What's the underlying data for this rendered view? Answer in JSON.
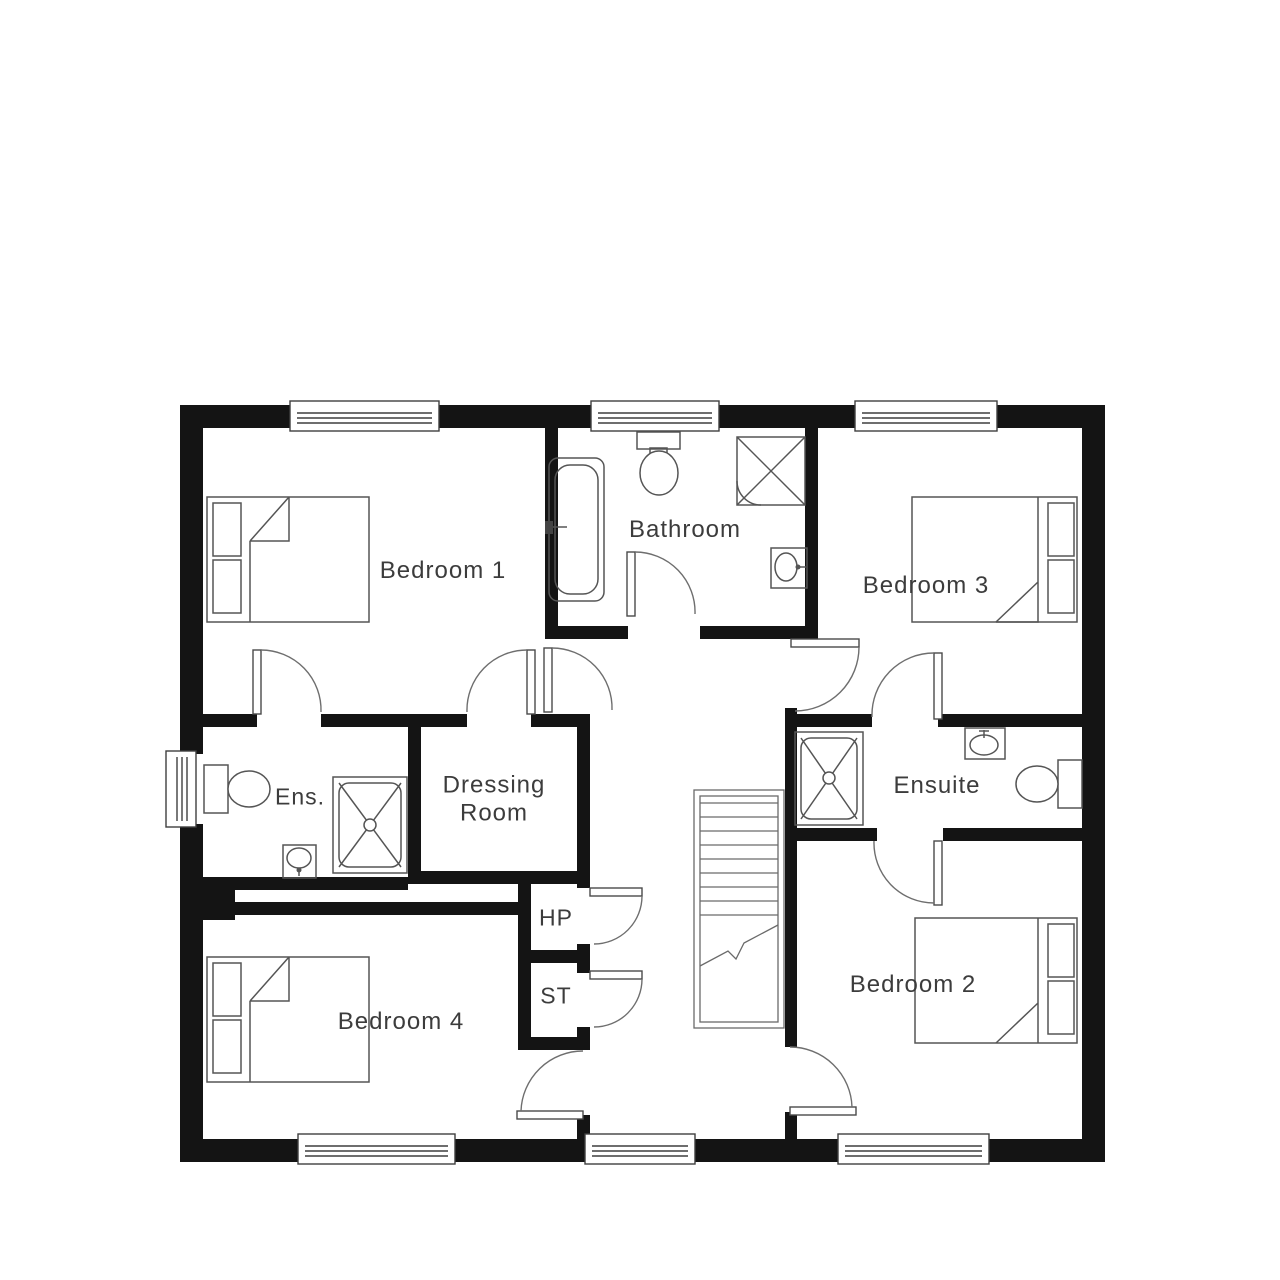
{
  "plan": {
    "title": "First floor plan",
    "rooms": [
      {
        "id": "bedroom-1",
        "label": "Bedroom 1"
      },
      {
        "id": "bathroom",
        "label": "Bathroom"
      },
      {
        "id": "bedroom-3",
        "label": "Bedroom 3"
      },
      {
        "id": "ens",
        "label": "Ens."
      },
      {
        "id": "dressing-room",
        "label": "Dressing Room"
      },
      {
        "id": "ensuite",
        "label": "Ensuite"
      },
      {
        "id": "hp",
        "label": "HP"
      },
      {
        "id": "st",
        "label": "ST"
      },
      {
        "id": "bedroom-4",
        "label": "Bedroom 4"
      },
      {
        "id": "bedroom-2",
        "label": "Bedroom 2"
      }
    ],
    "fixtures": [
      "double-bed",
      "bath",
      "shower",
      "toilet",
      "sink",
      "stairs",
      "door",
      "window"
    ],
    "colors": {
      "wall": "#141414",
      "line": "#555555",
      "light_line": "#8a8a8a",
      "text": "#3c3c3c",
      "background": "#ffffff"
    }
  }
}
